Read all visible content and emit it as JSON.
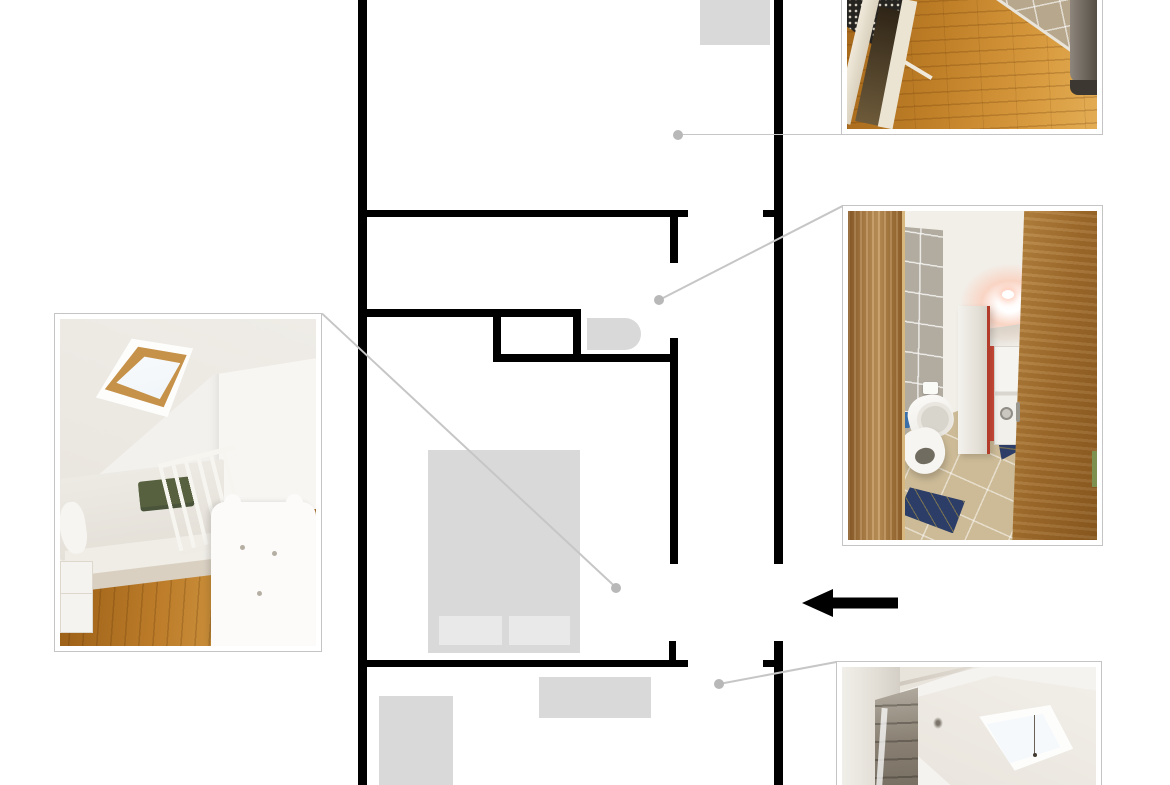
{
  "canvas": {
    "width": 1170,
    "height": 785,
    "background": "#ffffff"
  },
  "colors": {
    "wall": "#000000",
    "fixture": "#d9d9d9",
    "fixture_light": "#e9e9e9",
    "leader_line": "#c6c6c6",
    "callout_dot": "#b8b8b8",
    "photo_frame_border": "#c4c4c4",
    "photo_frame_bg": "#ffffff",
    "arrow": "#000000"
  },
  "floorplan": {
    "walls": [
      {
        "id": "outer-left",
        "x": 358,
        "y": 0,
        "w": 9,
        "h": 785
      },
      {
        "id": "outer-right-upper",
        "x": 774,
        "y": 0,
        "w": 9,
        "h": 564
      },
      {
        "id": "outer-right-lower",
        "x": 774,
        "y": 641,
        "w": 9,
        "h": 144
      },
      {
        "id": "hall-wall-left",
        "x": 358,
        "y": 210,
        "w": 330,
        "h": 7
      },
      {
        "id": "hall-wall-right",
        "x": 763,
        "y": 210,
        "w": 11,
        "h": 7
      },
      {
        "id": "bath-door-stub",
        "x": 670,
        "y": 210,
        "w": 8,
        "h": 53
      },
      {
        "id": "bath-wall-upper",
        "x": 358,
        "y": 309,
        "w": 223,
        "h": 8
      },
      {
        "id": "shower-box-left",
        "x": 493,
        "y": 309,
        "w": 8,
        "h": 53
      },
      {
        "id": "shower-box-right",
        "x": 573,
        "y": 309,
        "w": 8,
        "h": 53
      },
      {
        "id": "bath-wall-lower",
        "x": 493,
        "y": 354,
        "w": 185,
        "h": 8
      },
      {
        "id": "bedroom-divider",
        "x": 670,
        "y": 338,
        "w": 8,
        "h": 226
      },
      {
        "id": "lower-wall-left",
        "x": 358,
        "y": 660,
        "w": 330,
        "h": 7
      },
      {
        "id": "lower-wall-right",
        "x": 763,
        "y": 660,
        "w": 11,
        "h": 7
      },
      {
        "id": "lower-door-stub",
        "x": 669,
        "y": 641,
        "w": 7,
        "h": 26
      }
    ],
    "fixtures": [
      {
        "id": "top-cabinet",
        "x": 700,
        "y": 0,
        "w": 70,
        "h": 45,
        "color": "#d9d9d9"
      },
      {
        "id": "sink",
        "x": 587,
        "y": 318,
        "w": 54,
        "h": 32,
        "color": "#d9d9d9",
        "radius": "0 16px 16px 0"
      },
      {
        "id": "bed",
        "x": 428,
        "y": 450,
        "w": 152,
        "h": 203,
        "color": "#d9d9d9"
      },
      {
        "id": "pillow-left",
        "x": 439,
        "y": 616,
        "w": 63,
        "h": 29,
        "color": "#e9e9e9"
      },
      {
        "id": "pillow-right",
        "x": 509,
        "y": 616,
        "w": 61,
        "h": 29,
        "color": "#e9e9e9"
      },
      {
        "id": "sideboard",
        "x": 539,
        "y": 677,
        "w": 112,
        "h": 41,
        "color": "#d9d9d9"
      },
      {
        "id": "storage-box",
        "x": 379,
        "y": 696,
        "w": 74,
        "h": 89,
        "color": "#d9d9d9"
      }
    ]
  },
  "callouts": [
    {
      "id": "hallway",
      "dot": {
        "x": 678,
        "y": 134.5
      },
      "end": {
        "x": 842,
        "y": 134.5
      }
    },
    {
      "id": "bathroom",
      "dot": {
        "x": 659,
        "y": 300
      },
      "end": {
        "x": 842.5,
        "y": 206
      }
    },
    {
      "id": "bedroom",
      "dot": {
        "x": 616,
        "y": 587.5
      },
      "end": {
        "x": 322,
        "y": 313.5
      }
    },
    {
      "id": "skylight_room",
      "dot": {
        "x": 719,
        "y": 684
      },
      "end": {
        "x": 836.5,
        "y": 662
      }
    }
  ],
  "entry_arrow": {
    "direction": "left",
    "tip_x": 802,
    "tip_y": 603,
    "tail_x": 898,
    "head_length": 31,
    "head_half_height": 14,
    "shaft_thickness": 11
  },
  "photos": {
    "bedroom": {
      "frame": {
        "x": 54,
        "y": 313,
        "w": 268,
        "h": 339
      },
      "description": "Attic bedroom with skylight, double bed, green blankets, hardwood floor and white crib"
    },
    "hallway": {
      "frame": {
        "x": 841,
        "y": -40,
        "w": 262,
        "h": 175
      },
      "description": "Hallway with hardwood floor, dining chair with patterned cloth, tiled kitchen area and fridge"
    },
    "bathroom": {
      "frame": {
        "x": 842,
        "y": 205,
        "w": 261,
        "h": 341
      },
      "description": "Bathroom seen through wooden door with toilet, tiled wall, cabinet and stacked laundry machines"
    },
    "skylight_room": {
      "frame": {
        "x": 836,
        "y": 661,
        "w": 266,
        "h": 158
      },
      "description": "Attic room with slanted ceiling skylight and wardrobe with mirror"
    }
  }
}
